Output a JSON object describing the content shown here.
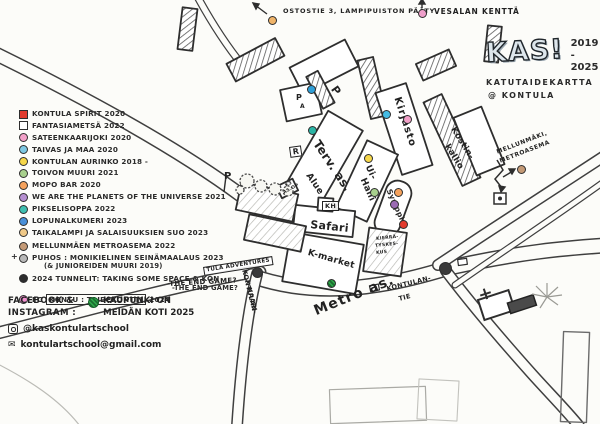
{
  "header": {
    "logo": "KAS!",
    "years_line1": "2019 -",
    "years_line2": "2025",
    "subtitle": "KATUTAIDEKARTTA",
    "location": "@ KONTULA"
  },
  "legend": {
    "items": [
      {
        "marker": {
          "color": "#e23b2e",
          "shape": "square"
        },
        "parts": [
          {
            "t": "KONTULA SPIRIT 2020"
          }
        ]
      },
      {
        "marker": {
          "color": "#ffffff",
          "shape": "square"
        },
        "parts": [
          {
            "t": "FANTASIAMETSÄ 2022"
          }
        ]
      },
      {
        "marker": {
          "color": "#f2a0c8",
          "shape": "circle"
        },
        "parts": [
          {
            "t": "SATEENKAARIJOKI 2020"
          }
        ]
      },
      {
        "marker": {
          "color": "#7ec8e3",
          "shape": "circle"
        },
        "parts": [
          {
            "t": "TAIVAS JA MAA 2020"
          }
        ]
      },
      {
        "marker": {
          "color": "#f6d74a",
          "shape": "circle"
        },
        "parts": [
          {
            "t": "KONTULAN AURINKO 2018 -"
          }
        ]
      },
      {
        "marker": {
          "color": "#a8d08d",
          "shape": "circle"
        },
        "parts": [
          {
            "t": "TOIVON MUURI 2021"
          }
        ]
      },
      {
        "marker": {
          "color": "#f5a25d",
          "shape": "circle"
        },
        "parts": [
          {
            "t": "MOPO BAR 2020"
          }
        ]
      },
      {
        "marker": {
          "color": "#b58fd0",
          "shape": "circle"
        },
        "parts": [
          {
            "t": "WE ARE THE PLANETS OF THE UNIVERSE 2021"
          }
        ]
      },
      {
        "marker": {
          "color": "#3fbfb0",
          "shape": "circle"
        },
        "parts": [
          {
            "t": "PIKSELISOPPA 2022"
          }
        ]
      },
      {
        "marker": {
          "color": "#4a90d9",
          "shape": "circle"
        },
        "parts": [
          {
            "t": "LOPUNALKUMERI 2023"
          }
        ]
      },
      {
        "marker": {
          "color": "#f0c987",
          "shape": "circle"
        },
        "parts": [
          {
            "t": "TAIKALAMPI JA SALAISUUKSIEN SUO 2023"
          }
        ]
      },
      {
        "marker": {
          "color": "#c49a76",
          "shape": "circle"
        },
        "parts": [
          {
            "t": "MELLUNMÄEN METROASEMA 2022"
          }
        ]
      },
      {
        "marker": {
          "color": "#b8b8b8",
          "shape": "circle",
          "prefix": "+"
        },
        "parts": [
          {
            "t": "PUHOS : MONIKIELINEN SEINÄMAALAUS 2023"
          }
        ],
        "line2": "(& JUNIOREIDEN MUURI 2019)"
      },
      {
        "marker": {
          "color": "#2d2d2d",
          "shape": "circle"
        },
        "parts": [
          {
            "t": "2024 TUNNELIT: TAKING SOME SPACE & KON"
          }
        ],
        "line2": "-THE END GAME?"
      },
      {
        "marker": {
          "color": "#f291d0",
          "shape": "circle"
        },
        "parts": [
          {
            "t": "FC "
          },
          {
            "t": "KONTU : TAIDEKONTTI",
            "box": true
          },
          {
            "t": " 2024"
          }
        ]
      }
    ]
  },
  "social": {
    "line1": "FACEBOOK &",
    "line2": "INSTAGRAM :",
    "note1": "KAUPUNKI ON",
    "note2": "MEIDÄN KOTI 2025",
    "handle": "@kaskontulartschool",
    "email_icon": "✉",
    "email": "kontulartschool@gmail.com"
  },
  "map": {
    "labels": [
      {
        "text": "OSTOSTIE 3, LAMPIPUISTON PÄÄTY",
        "x": 283,
        "y": 8,
        "rot": 0,
        "size": 6.5,
        "ls": 0.8
      },
      {
        "text": "VESALAN KENTTÄ",
        "x": 434,
        "y": 8,
        "rot": 0,
        "size": 7.5,
        "ls": 0.8
      },
      {
        "text": "P",
        "x": 224,
        "y": 172,
        "rot": 0,
        "size": 10
      },
      {
        "text": "P",
        "x": 338,
        "y": 84,
        "rot": 55,
        "size": 11
      },
      {
        "text": "P",
        "x": 296,
        "y": 94,
        "rot": 0,
        "size": 8
      },
      {
        "text": "A",
        "x": 300,
        "y": 104,
        "rot": 0,
        "size": 6
      },
      {
        "text": "R",
        "x": 289,
        "y": 147,
        "rot": -8,
        "size": 8,
        "boxed": true
      },
      {
        "text": "Terv. as.",
        "x": 321,
        "y": 138,
        "rot": 56,
        "size": 12
      },
      {
        "text": "Alue",
        "x": 311,
        "y": 172,
        "rot": 56,
        "size": 9
      },
      {
        "text": "Kirjasto",
        "x": 401,
        "y": 96,
        "rot": 72,
        "size": 10,
        "ls": 1
      },
      {
        "text": "Ui-",
        "x": 371,
        "y": 164,
        "rot": 66,
        "size": 9
      },
      {
        "text": "Halli",
        "x": 366,
        "y": 177,
        "rot": 66,
        "size": 9
      },
      {
        "text": "Symppis",
        "x": 392,
        "y": 188,
        "rot": 66,
        "size": 7.5
      },
      {
        "text": "KH",
        "x": 322,
        "y": 201,
        "rot": 0,
        "size": 6.5,
        "boxed": true
      },
      {
        "text": "Safari",
        "x": 311,
        "y": 219,
        "rot": 6,
        "size": 11
      },
      {
        "text": "K-market",
        "x": 309,
        "y": 249,
        "rot": 16,
        "size": 9
      },
      {
        "text": "K3",
        "x": 285,
        "y": 185,
        "rot": -28,
        "size": 4.5
      },
      {
        "text": "AS.OP",
        "x": 283,
        "y": 192,
        "rot": -28,
        "size": 4.5
      },
      {
        "text": "KIERRÄ-",
        "x": 376,
        "y": 238,
        "rot": -6,
        "size": 4.5
      },
      {
        "text": "TYSKES-",
        "x": 375,
        "y": 245,
        "rot": -6,
        "size": 4.5
      },
      {
        "text": "KUS",
        "x": 376,
        "y": 252,
        "rot": -6,
        "size": 4.5
      },
      {
        "text": "Kostin-",
        "x": 456,
        "y": 126,
        "rot": 58,
        "size": 8.5
      },
      {
        "text": "kallio",
        "x": 450,
        "y": 143,
        "rot": 58,
        "size": 8.5
      },
      {
        "text": "MELLUNMÄKI,",
        "x": 496,
        "y": 150,
        "rot": -21,
        "size": 6,
        "ls": 0.6
      },
      {
        "text": "METROASEMA",
        "x": 499,
        "y": 159,
        "rot": -21,
        "size": 6,
        "ls": 0.6
      },
      {
        "text": "Metro as.",
        "x": 312,
        "y": 305,
        "rot": -22,
        "size": 14,
        "ls": 1.2
      },
      {
        "text": "KONTULAN-",
        "x": 386,
        "y": 286,
        "rot": -14,
        "size": 6.5
      },
      {
        "text": "TIE",
        "x": 398,
        "y": 296,
        "rot": -14,
        "size": 6.5
      },
      {
        "text": "KONTULAN-",
        "x": 247,
        "y": 269,
        "rot": 76,
        "size": 6.5
      },
      {
        "text": "KAARI",
        "x": 252,
        "y": 287,
        "rot": 76,
        "size": 6.5
      },
      {
        "text": "TULA ADVENTURES",
        "x": 203,
        "y": 267,
        "rot": -9,
        "size": 5.5,
        "boxed": true
      },
      {
        "text": "-THE END GAME?",
        "x": 167,
        "y": 281,
        "rot": -3,
        "size": 7
      }
    ],
    "dots": [
      {
        "color": "#f0b469",
        "x": 272,
        "y": 20
      },
      {
        "color": "#ef9fca",
        "x": 422,
        "y": 13
      },
      {
        "color": "#2f9fd8",
        "x": 311,
        "y": 89
      },
      {
        "color": "#2ab5a5",
        "x": 312,
        "y": 130
      },
      {
        "color": "#45bce4",
        "x": 386,
        "y": 114
      },
      {
        "color": "#f2a0c8",
        "x": 407,
        "y": 119
      },
      {
        "color": "#f6d74a",
        "x": 368,
        "y": 158
      },
      {
        "color": "#a8d08d",
        "x": 374,
        "y": 192
      },
      {
        "color": "#f5a25d",
        "x": 398,
        "y": 192
      },
      {
        "color": "#9b6bb3",
        "x": 394,
        "y": 204
      },
      {
        "color": "#e23b2e",
        "x": 403,
        "y": 224
      },
      {
        "color": "#2faa4a",
        "x": 331,
        "y": 283,
        "pattern": true
      },
      {
        "color": "#c49a76",
        "x": 521,
        "y": 169
      },
      {
        "color": "#3a3a3a",
        "x": 257,
        "y": 272,
        "r": 5.5
      },
      {
        "color": "#3a3a3a",
        "x": 445,
        "y": 268,
        "r": 6.5
      }
    ]
  }
}
